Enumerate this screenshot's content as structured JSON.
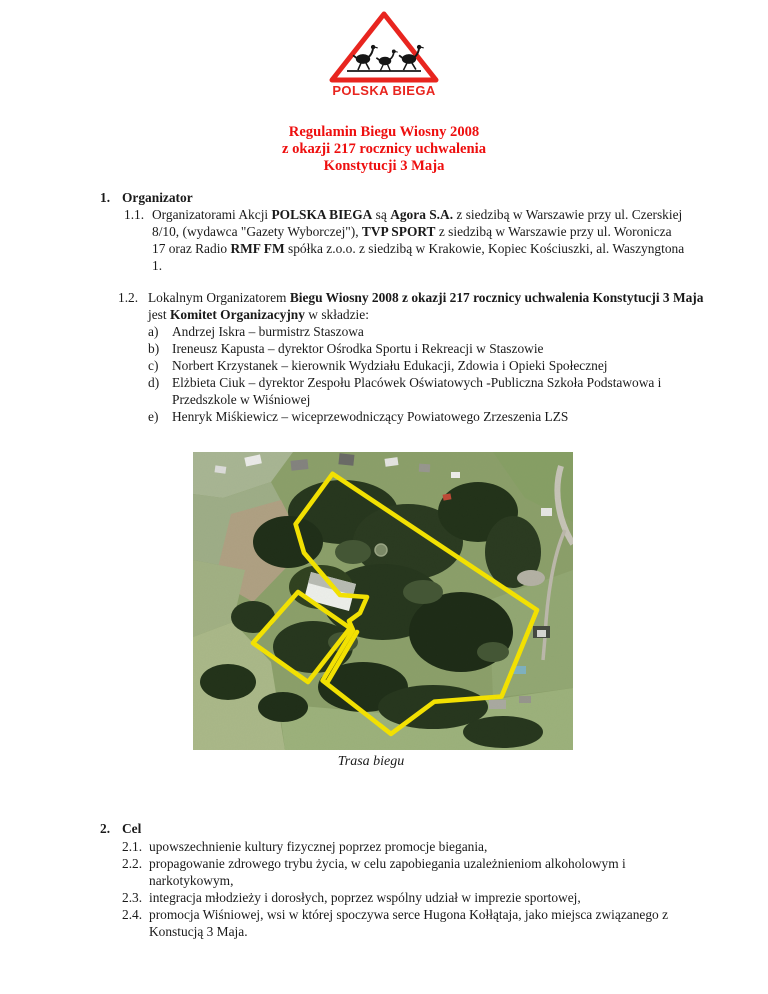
{
  "logo": {
    "label": "POLSKA BIEGA"
  },
  "title": {
    "line1": "Regulamin Biegu Wiosny 2008",
    "line2": "z okazji 217 rocznicy uchwalenia",
    "line3": "Konstytucji 3 Maja"
  },
  "section1": {
    "number": "1.",
    "heading": "Organizator",
    "item11": {
      "marker": "1.1.",
      "runs": [
        "Organizatorami Akcji ",
        "POLSKA BIEGA",
        " są ",
        "Agora S.A.",
        " z siedzibą w Warszawie przy ul. Czerskiej 8/10, (wydawca \"Gazety Wyborczej\"), ",
        "TVP SPORT",
        " z siedzibą w Warszawie przy ul. Woronicza 17 oraz Radio ",
        "RMF FM",
        " spółka z.o.o. z siedzibą w Krakowie, Kopiec Kościuszki, al. Waszyngtona 1."
      ]
    },
    "item12": {
      "marker": "1.2.",
      "runs": [
        "Lokalnym Organizatorem ",
        "Biegu Wiosny 2008 z okazji 217 rocznicy uchwalenia Konstytucji 3 Maja",
        " jest ",
        "Komitet Organizacyjny",
        " w składzie:"
      ],
      "list": [
        {
          "marker": "a)",
          "text": "Andrzej Iskra – burmistrz Staszowa"
        },
        {
          "marker": "b)",
          "text": "Ireneusz Kapusta – dyrektor Ośrodka Sportu i Rekreacji w Staszowie"
        },
        {
          "marker": "c)",
          "text": "Norbert Krzystanek – kierownik Wydziału Edukacji, Zdowia i Opieki Społecznej"
        },
        {
          "marker": "d)",
          "text": "Elżbieta Ciuk – dyrektor Zespołu Placówek Oświatowych -Publiczna Szkoła Podstawowa i Przedszkole w Wiśniowej"
        },
        {
          "marker": "e)",
          "text": "Henryk Miśkiewicz – wiceprzewodniczący Powiatowego Zrzeszenia LZS"
        }
      ]
    }
  },
  "figure": {
    "caption": "Trasa biegu"
  },
  "section2": {
    "number": "2.",
    "heading": "Cel",
    "items": [
      {
        "marker": "2.1.",
        "text": "upowszechnienie kultury fizycznej poprzez promocje biegania,"
      },
      {
        "marker": "2.2.",
        "text": "propagowanie zdrowego trybu życia, w celu zapobiegania uzależnieniom alkoholowym i narkotykowym,"
      },
      {
        "marker": "2.3.",
        "text": "integracja młodzieży i dorosłych, poprzez wspólny udział w imprezie sportowej,"
      },
      {
        "marker": "2.4.",
        "text": "promocja Wiśniowej, wsi w której spoczywa serce Hugona Kołłątaja, jako miejsca związanego z Konstucją 3 Maja."
      }
    ]
  },
  "colors": {
    "title_red": "#ee0f0f",
    "logo_red": "#e8251f",
    "route_yellow": "#f6e400"
  }
}
